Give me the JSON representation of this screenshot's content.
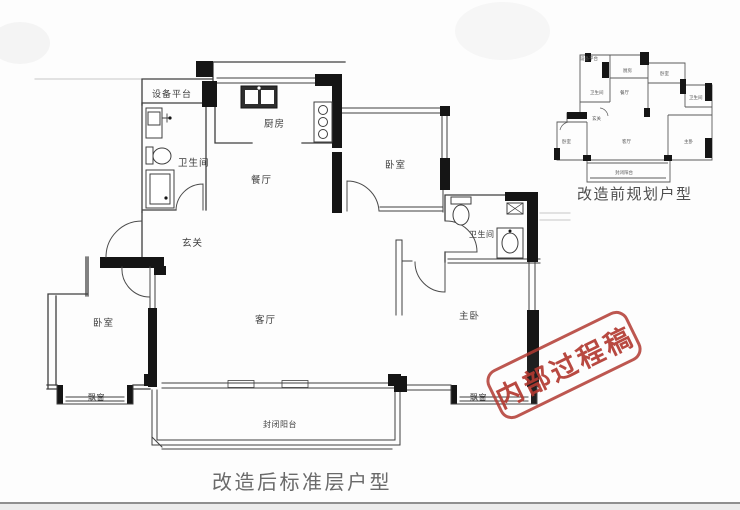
{
  "main_plan": {
    "caption": "改造后标准层户型",
    "rooms": {
      "equipment_platform": "设备平台",
      "bathroom_left": "卫生间",
      "kitchen": "厨房",
      "dining": "餐厅",
      "entry": "玄关",
      "bedroom_top": "卧室",
      "bedroom_left": "卧室",
      "living": "客厅",
      "bathroom_right": "卫生间",
      "master": "主卧",
      "bay_left": "飘窗",
      "bay_right": "飘窗",
      "balcony": "封闭阳台"
    }
  },
  "inset_plan": {
    "caption": "改造前规划户型",
    "rooms": {
      "equipment_platform": "设备平台",
      "bathroom_left": "卫生间",
      "kitchen": "厨房",
      "dining": "餐厅",
      "entry": "玄关",
      "bedroom_top": "卧室",
      "bedroom_left": "卧室",
      "living": "客厅",
      "bathroom_right": "卫生间",
      "master": "主卧",
      "balcony": "封闭阳台"
    }
  },
  "stamp": {
    "text": "内部过程稿",
    "color": "#b23a31"
  },
  "colors": {
    "wall_black": "#151515",
    "line_gray": "#3f3f3f",
    "caption_gray": "#6a6a6a",
    "stamp_red": "#b23a31"
  }
}
